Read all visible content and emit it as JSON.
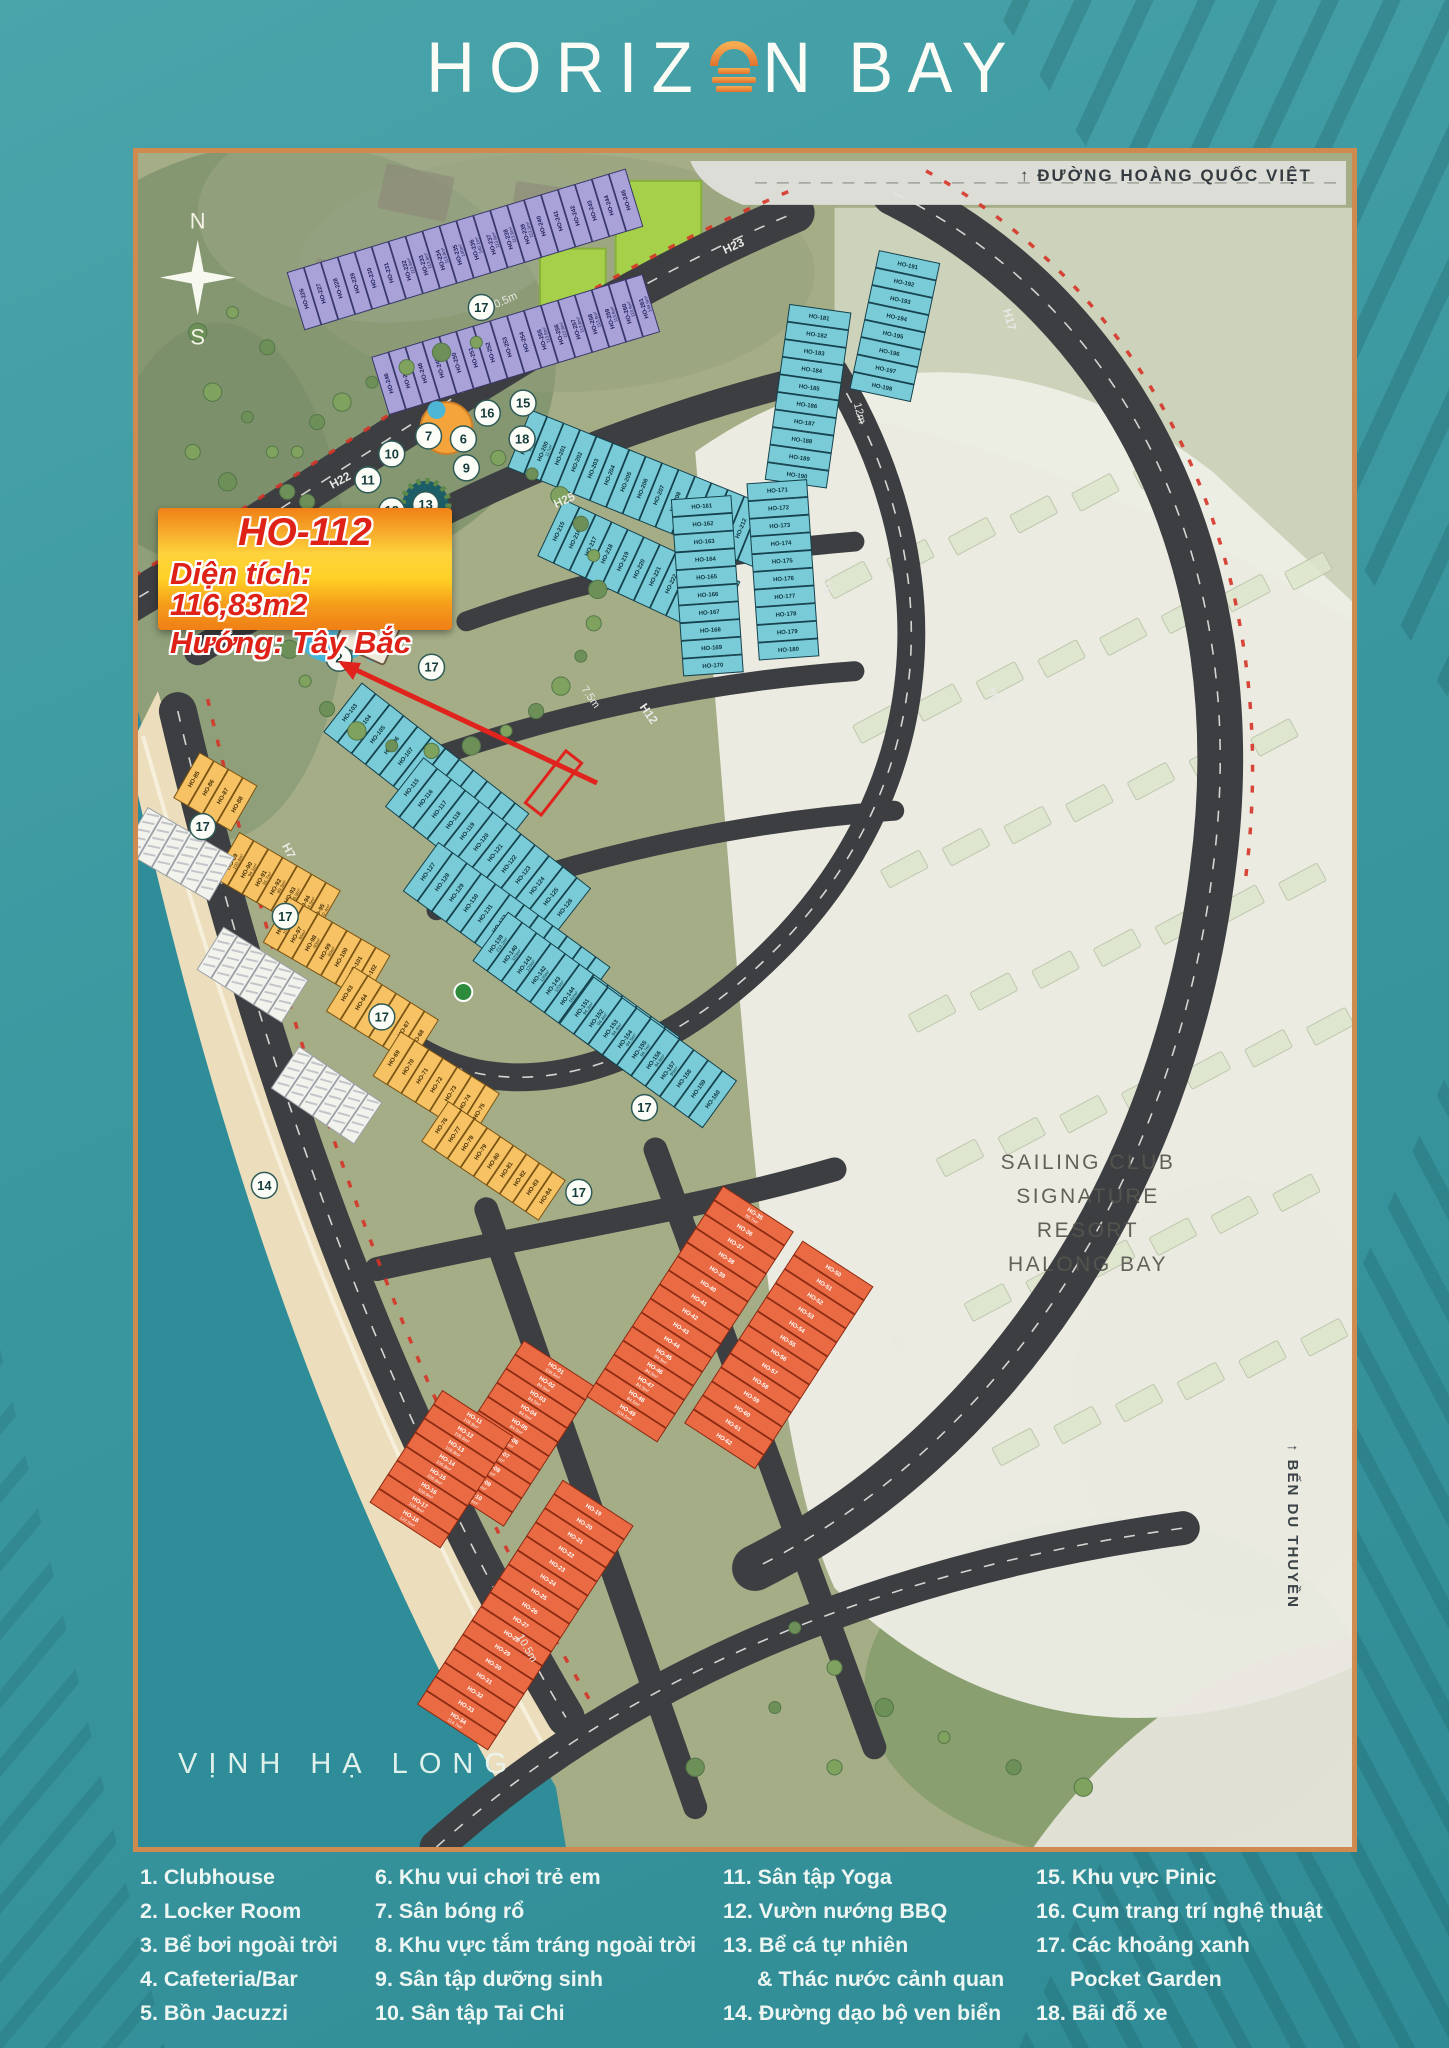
{
  "logo": {
    "part1": "HORIZ",
    "part2": "N",
    "part3": "BAY"
  },
  "compass": {
    "north": "N",
    "south": "S"
  },
  "callout": {
    "line1": "HO-112",
    "line2": "Diện tích: 116,83m2",
    "line3": "Hướng: Tây Bắc"
  },
  "labels": {
    "top_road": "↑ ĐƯỜNG HOÀNG QUỐC VIỆT",
    "bay": "VỊNH HẠ LONG",
    "marina": "↑ BẾN DU THUYỀN",
    "resort_line1": "SAILING CLUB",
    "resort_line2": "SIGNATURE RESORT",
    "resort_line3": "HALONG BAY"
  },
  "road_labels": [
    "H22",
    "H23",
    "H25",
    "H12",
    "H16",
    "H17",
    "H7",
    "H8"
  ],
  "width_labels": [
    "10.5m",
    "7.5m",
    "12m",
    "10.5m",
    "7.5m"
  ],
  "amenity_markers": [
    1,
    2,
    3,
    4,
    5,
    6,
    7,
    8,
    9,
    10,
    11,
    12,
    13,
    14,
    15,
    16,
    17,
    17,
    17,
    17,
    17,
    17,
    17,
    18
  ],
  "legend": {
    "columns": [
      [
        {
          "num": "1.",
          "label": "Clubhouse"
        },
        {
          "num": "2.",
          "label": "Locker Room"
        },
        {
          "num": "3.",
          "label": "Bể bơi ngoài trời"
        },
        {
          "num": "4.",
          "label": "Cafeteria/Bar"
        },
        {
          "num": "5.",
          "label": "Bồn Jacuzzi"
        }
      ],
      [
        {
          "num": "6.",
          "label": "Khu vui chơi trẻ em"
        },
        {
          "num": "7.",
          "label": "Sân bóng rổ"
        },
        {
          "num": "8.",
          "label": "Khu vực tắm tráng ngoài trời"
        },
        {
          "num": "9.",
          "label": "Sân tập dưỡng sinh"
        },
        {
          "num": "10.",
          "label": "Sân tập Tai Chi"
        }
      ],
      [
        {
          "num": "11.",
          "label": "Sân tập Yoga"
        },
        {
          "num": "12.",
          "label": "Vườn nướng BBQ"
        },
        {
          "num": "13.",
          "label": "Bể cá tự nhiên",
          "label2": "& Thác nước cảnh quan"
        },
        {
          "num": "14.",
          "label": "Đường dạo bộ ven biển"
        }
      ],
      [
        {
          "num": "15.",
          "label": "Khu vực Pinic"
        },
        {
          "num": "16.",
          "label": "Cụm trang trí nghệ thuật"
        },
        {
          "num": "17.",
          "label": "Các khoảng xanh",
          "label2": "Pocket Garden"
        },
        {
          "num": "18.",
          "label": "Bãi đỗ xe"
        }
      ]
    ]
  },
  "lot_blocks": [
    {
      "key": "purple1",
      "prefix": "HO-",
      "from": 226,
      "to": 245,
      "color": "purple"
    },
    {
      "key": "purple2",
      "prefix": "HO-",
      "from": 246,
      "to": 261,
      "color": "purple"
    },
    {
      "key": "teal_t1",
      "prefix": "HO-",
      "from": 199,
      "to": 214,
      "color": "teal"
    },
    {
      "key": "teal_t2",
      "prefix": "HO-",
      "from": 215,
      "to": 225,
      "color": "teal"
    },
    {
      "key": "teal_t3",
      "prefix": "HO-",
      "from": 181,
      "to": 190,
      "color": "teal"
    },
    {
      "key": "teal_t4",
      "prefix": "HO-",
      "from": 191,
      "to": 198,
      "color": "teal"
    },
    {
      "key": "teal_t5a",
      "prefix": "HO-",
      "from": 171,
      "to": 180,
      "color": "teal"
    },
    {
      "key": "teal_t5b",
      "prefix": "HO-",
      "from": 161,
      "to": 170,
      "color": "teal"
    },
    {
      "key": "teal_t6a",
      "prefix": "HO-",
      "from": 103,
      "to": 114,
      "color": "teal"
    },
    {
      "key": "teal_t6b",
      "prefix": "HO-",
      "from": 115,
      "to": 126,
      "color": "teal"
    },
    {
      "key": "teal_t7",
      "prefix": "HO-",
      "from": 127,
      "to": 138,
      "color": "teal"
    },
    {
      "key": "teal_t8",
      "prefix": "HO-",
      "from": 139,
      "to": 150,
      "color": "teal"
    },
    {
      "key": "teal_t9",
      "prefix": "HO-",
      "from": 151,
      "to": 160,
      "color": "teal"
    },
    {
      "key": "yellow1",
      "prefix": "HO-",
      "from": 85,
      "to": 88,
      "color": "yellow"
    },
    {
      "key": "yellow2",
      "prefix": "HO-",
      "from": 89,
      "to": 95,
      "color": "yellow"
    },
    {
      "key": "yellow3",
      "prefix": "HO-",
      "from": 96,
      "to": 102,
      "color": "yellow"
    },
    {
      "key": "yellow4",
      "prefix": "HO-",
      "from": 63,
      "to": 68,
      "color": "yellow"
    },
    {
      "key": "yellow5",
      "prefix": "HO-",
      "from": 69,
      "to": 75,
      "color": "yellow"
    },
    {
      "key": "yellow6",
      "prefix": "HO-",
      "from": 76,
      "to": 84,
      "color": "yellow"
    },
    {
      "key": "orange1",
      "prefix": "HO-",
      "from": 1,
      "to": 10,
      "color": "orange"
    },
    {
      "key": "orange2",
      "prefix": "HO-",
      "from": 11,
      "to": 18,
      "color": "orange"
    },
    {
      "key": "orange3",
      "prefix": "HO-",
      "from": 35,
      "to": 49,
      "color": "orange"
    },
    {
      "key": "orange4",
      "prefix": "HO-",
      "from": 50,
      "to": 62,
      "color": "orange"
    },
    {
      "key": "orange5",
      "prefix": "HO-",
      "from": 19,
      "to": 34,
      "color": "orange"
    },
    {
      "key": "white1",
      "count": 6,
      "color": "white"
    },
    {
      "key": "white2",
      "count": 6,
      "color": "white"
    },
    {
      "key": "white3",
      "count": 6,
      "color": "white"
    }
  ],
  "lot_areas": {
    "HO-01": "108.5m²",
    "HO-02": "84.5m²",
    "HO-03": "84.5m²",
    "HO-04": "84.5m²",
    "HO-05": "84.5m²",
    "HO-06": "84.5m²",
    "HO-07": "84.5m²",
    "HO-08": "84.5m²",
    "HO-09": "87.5m²",
    "HO-10": "123.4m²",
    "HO-11": "106.9m²",
    "HO-12": "106.9m²",
    "HO-13": "106.9m²",
    "HO-14": "106.9m²",
    "HO-15": "106.9m²",
    "HO-16": "106.9m²",
    "HO-17": "106.9m²",
    "HO-18": "122.5m²",
    "HO-34": "114.7m²",
    "HO-35": "86.7m²",
    "HO-45": "84.3m²",
    "HO-46": "84.3m²",
    "HO-47": "84.3m²",
    "HO-48": "84.5m²",
    "HO-49": "104.5m²",
    "HO-89": "100.4m²",
    "HO-90": "94.1m²",
    "HO-91": "91.7m²",
    "HO-92": "89.3m²",
    "HO-93": "86.9m²",
    "HO-94": "84.5m²",
    "HO-95": "102.4m²",
    "HO-96": "109.9m²",
    "HO-97": "90m²",
    "HO-98": "90m²",
    "HO-99": "90m²",
    "HO-112": "116.8m²",
    "HO-113": "116.9m²",
    "HO-114": "124.6m²",
    "HO-139": "213.2m²",
    "HO-140": "120m²",
    "HO-141": "120m²",
    "HO-142": "120m²",
    "HO-143": "120m²",
    "HO-144": "162m²",
    "HO-151": "94.3m²",
    "HO-152": "94.4m²",
    "HO-153": "94.4m²",
    "HO-154": "94.5m²",
    "HO-155": "94.7m²",
    "HO-156": "94.8m²",
    "HO-157": "95m²",
    "HO-199": "140.6m²",
    "HO-200": "117m²",
    "HO-232": "113.8m²",
    "HO-233": "113.8m²",
    "HO-234": "113.8m²",
    "HO-235": "140m²",
    "HO-236": "140.1m²",
    "HO-237": "113.8m²",
    "HO-238": "113.8m²",
    "HO-239": "113.5m²",
    "HO-255": "113.8m²",
    "HO-256": "113.8m²",
    "HO-257": "113.8m²",
    "HO-258": "113.8m²",
    "HO-259": "113.8m²",
    "HO-260": "113.9m²",
    "HO-261": "149.9m²"
  },
  "colors": {
    "purple": "#a9a2d9",
    "teal": "#79ccd7",
    "yellow": "#f6c264",
    "orange": "#e96a43",
    "white_lot": "#f3f3ee",
    "road": "#3c3e42",
    "border": "#cf8a50",
    "sea": "#2e8d99",
    "accent_red": "#e0231d",
    "callout_red": "#df2218",
    "park_green": "#a6cf4a"
  }
}
